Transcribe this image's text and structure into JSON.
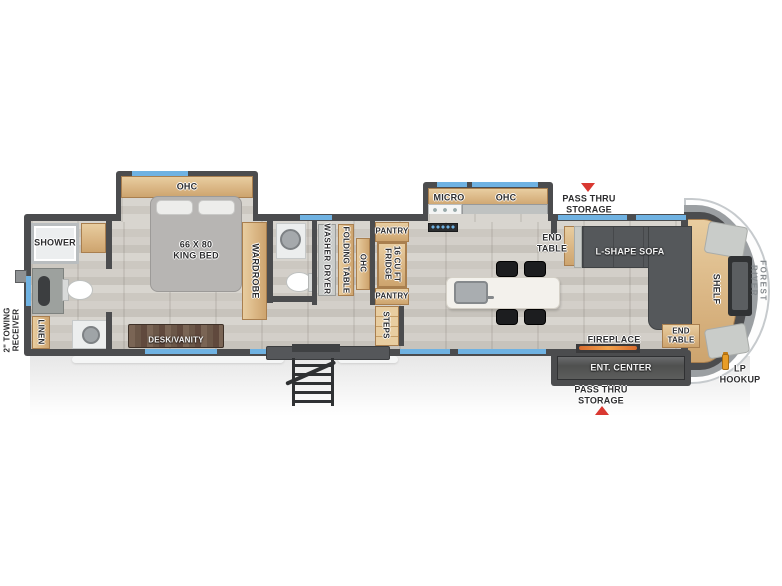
{
  "colors": {
    "wall": "#4b4c4e",
    "wood": "#dab684",
    "window_blue": "#6fb2e2",
    "sofa_gray": "#55585b",
    "accent_red": "#d93831",
    "lp_orange": "#e89d27"
  },
  "exterior": {
    "brand": "FOREST RIVER",
    "towing_receiver": "2\" TOWING\nRECEIVER",
    "pass_thru_storage_top": "PASS THRU\nSTORAGE",
    "pass_thru_storage_bottom": "PASS THRU\nSTORAGE",
    "lp_hookup": "LP\nHOOKUP"
  },
  "front_bath": {
    "shower": "SHOWER",
    "linen": "LINEN"
  },
  "bedroom": {
    "ohc": "OHC",
    "bed": "66 X 80\nKING BED",
    "wardrobe": "WARDROBE",
    "desk_vanity": "DESK/VANITY"
  },
  "laundry": {
    "washer_dryer": "WASHER  DRYER",
    "folding_table": "FOLDING TABLE",
    "ohc": "OHC"
  },
  "kitchen": {
    "micro": "MICRO",
    "ohc": "OHC",
    "pantry_top": "PANTRY",
    "fridge": "16 CU FT\nFRIDGE",
    "pantry_bottom": "PANTRY",
    "steps": "STEPS"
  },
  "living": {
    "end_table_front": "END\nTABLE",
    "sofa": "L-SHAPE SOFA",
    "end_table_rear": "END\nTABLE",
    "fireplace": "FIREPLACE",
    "ent_center": "ENT. CENTER",
    "shelf": "SHELF"
  }
}
